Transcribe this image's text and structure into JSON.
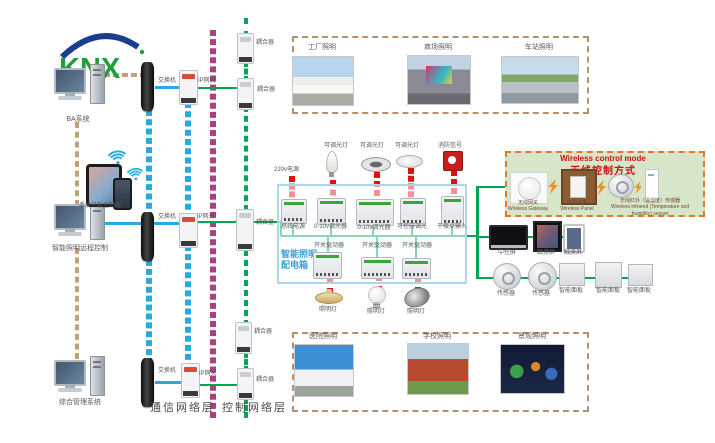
{
  "logo": {
    "text": "KNX"
  },
  "left": {
    "computers": [
      {
        "label": "BA系统"
      },
      {
        "label": "智能照明远程控制"
      },
      {
        "label": "综合管理系统"
      }
    ],
    "mobile_label": "手机平板控制端"
  },
  "network": {
    "switches": [
      "交换机",
      "交换机",
      "交换机"
    ],
    "gateways": [
      "IP网关",
      "IP网关",
      "IP网关"
    ],
    "couplers": [
      "耦合器",
      "耦合器",
      "耦合器",
      "耦合器",
      "耦合器"
    ],
    "layers": {
      "comm": "通信网络层",
      "ctrl": "控制网络层"
    }
  },
  "zones": {
    "top": [
      {
        "label": "工厂照明"
      },
      {
        "label": "商场照明"
      },
      {
        "label": "车站照明"
      }
    ],
    "bottom": [
      {
        "label": "医院照明"
      },
      {
        "label": "学校照明"
      },
      {
        "label": "景观照明"
      }
    ]
  },
  "panel": {
    "title_line1": "智能照明",
    "title_line2": "配电箱",
    "power_input": "220v电源",
    "loads_top": [
      "可调光灯",
      "可调光灯",
      "可调光灯",
      "消防信号"
    ],
    "modules_top": [
      "总线电源",
      "0-10v调光器",
      "0-10v调光器",
      "可控硅调光",
      "干接点输入"
    ],
    "modules_bottom": [
      "开关驱动器",
      "开关驱动器",
      "开关驱动器"
    ],
    "loads_bottom": [
      "照明灯",
      "照明灯",
      "照明灯"
    ]
  },
  "wireless": {
    "title_en": "Wireless control mode",
    "title_zh": "无线控制方式",
    "gateway_zh": "无线网关",
    "gateway_en": "Wireless Gateway",
    "panel_zh": "无线面板",
    "panel_en": "Wireless Panel",
    "sensor_zh": "无线红外（温湿度）传感器",
    "sensor_en1": "Wireless infrared (Temperature and",
    "sensor_en2": "humidity) sensor"
  },
  "devices": {
    "row1": [
      "中控屏",
      "触摸屏",
      "触摸屏"
    ],
    "row2": [
      "传感器",
      "传感器",
      "智能面板",
      "智能面板",
      "智能面板"
    ]
  },
  "colors": {
    "bus_green": "#00a651",
    "ip_blue": "#2aa9e0",
    "load_red": "#e01010",
    "backbone_magenta": "#b03d80",
    "mgmt_tan": "#c2a274"
  }
}
